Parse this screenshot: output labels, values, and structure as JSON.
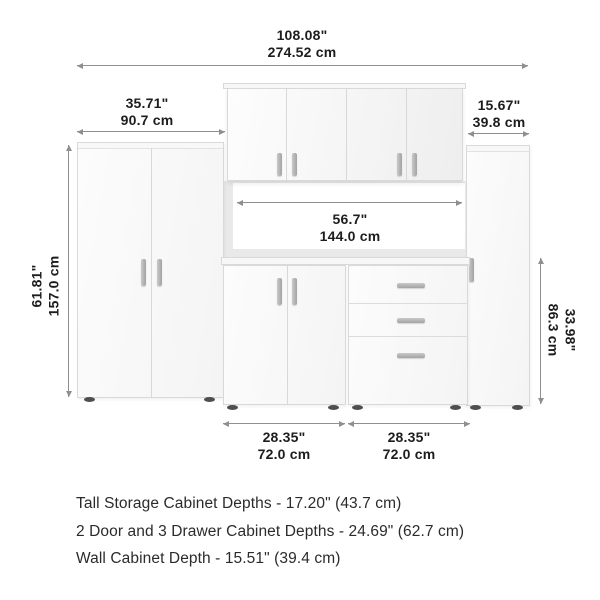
{
  "diagram": {
    "dimensions": {
      "overall_width": {
        "inches": "108.08\"",
        "metric": "274.52 cm"
      },
      "tall_cabinet_width": {
        "inches": "35.71\"",
        "metric": "90.7 cm"
      },
      "narrow_cabinet_width": {
        "inches": "15.67\"",
        "metric": "39.8 cm"
      },
      "middle_span_width": {
        "inches": "56.7\"",
        "metric": "144.0 cm"
      },
      "tall_cabinet_height": {
        "inches": "61.81\"",
        "metric": "157.0 cm"
      },
      "base_cabinet_height": {
        "inches": "33.98\"",
        "metric": "86.3 cm"
      },
      "base_left_width": {
        "inches": "28.35\"",
        "metric": "72.0 cm"
      },
      "base_right_width": {
        "inches": "28.35\"",
        "metric": "72.0 cm"
      }
    },
    "notes": [
      "Tall Storage Cabinet Depths - 17.20\" (43.7 cm)",
      "2 Door and 3 Drawer Cabinet Depths - 24.69\" (62.7 cm)",
      "Wall Cabinet Depth - 15.51\" (39.4 cm)"
    ]
  },
  "colors": {
    "background": "#ffffff",
    "cabinet_border": "#d9d9d9",
    "wall_backdrop": "#e9e9e9",
    "dim_line": "#8f8f8f",
    "text": "#1d1d1d",
    "handle": "#b5b5b5",
    "foot": "#4f4f4f"
  }
}
